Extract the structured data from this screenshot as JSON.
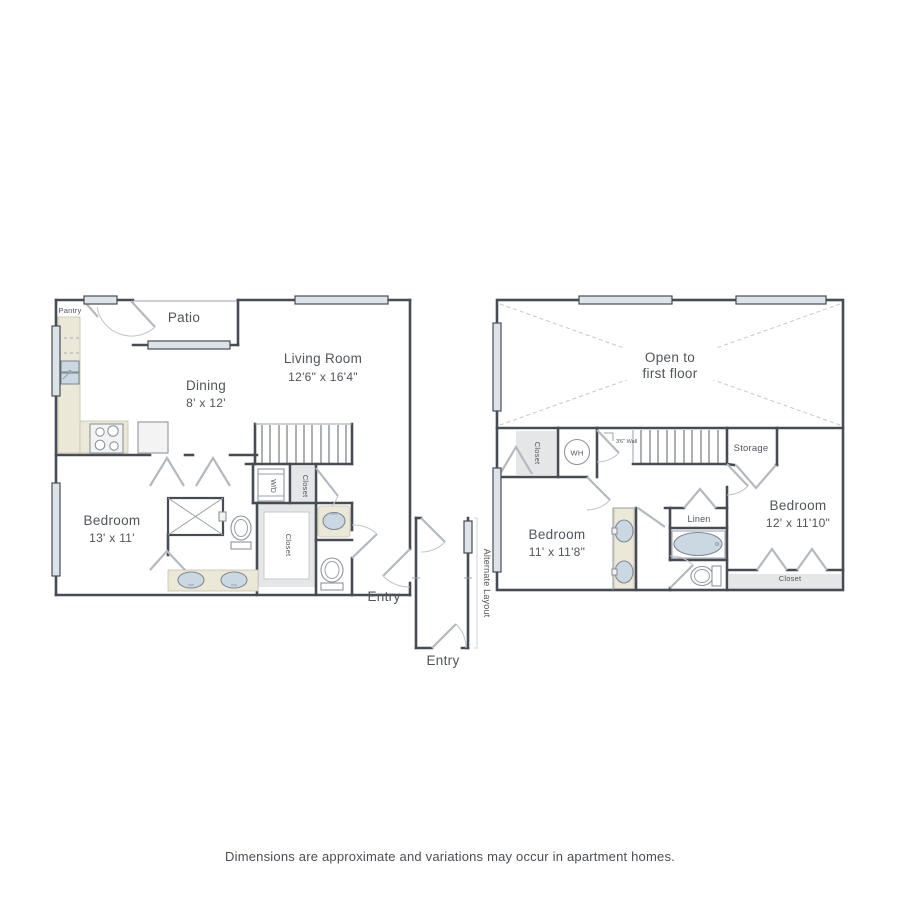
{
  "floor1": {
    "pantry": "Pantry",
    "patio": "Patio",
    "dining_name": "Dining",
    "dining_dims": "8' x 12'",
    "living_name": "Living Room",
    "living_dims": "12'6\" x 16'4\"",
    "bedroom_name": "Bedroom",
    "bedroom_dims": "13' x 11'",
    "wd": "W/D",
    "closet_hall": "Closet",
    "closet_walkin": "Closet",
    "entry": "Entry"
  },
  "alternate": {
    "label": "Alternate Layout",
    "entry": "Entry"
  },
  "floor2": {
    "open_line1": "Open to",
    "open_line2": "first floor",
    "closet_upper": "Closet",
    "wh": "WH",
    "wall_note": "3'6\" Wall",
    "storage": "Storage",
    "bedroom_left_name": "Bedroom",
    "bedroom_left_dims": "11' x 11'8\"",
    "bedroom_right_name": "Bedroom",
    "bedroom_right_dims": "12' x 11'10\"",
    "linen": "Linen",
    "closet_right": "Closet"
  },
  "footer": {
    "disclaimer": "Dimensions are approximate and variations may occur in apartment homes."
  },
  "colors": {
    "wall": "#474c54",
    "window_fill": "#dde4e9",
    "counter_beige": "#ece8d7",
    "fixture_blue": "#c9d8e3",
    "closet_gray": "#e5e6e7",
    "text": "#50555b"
  }
}
